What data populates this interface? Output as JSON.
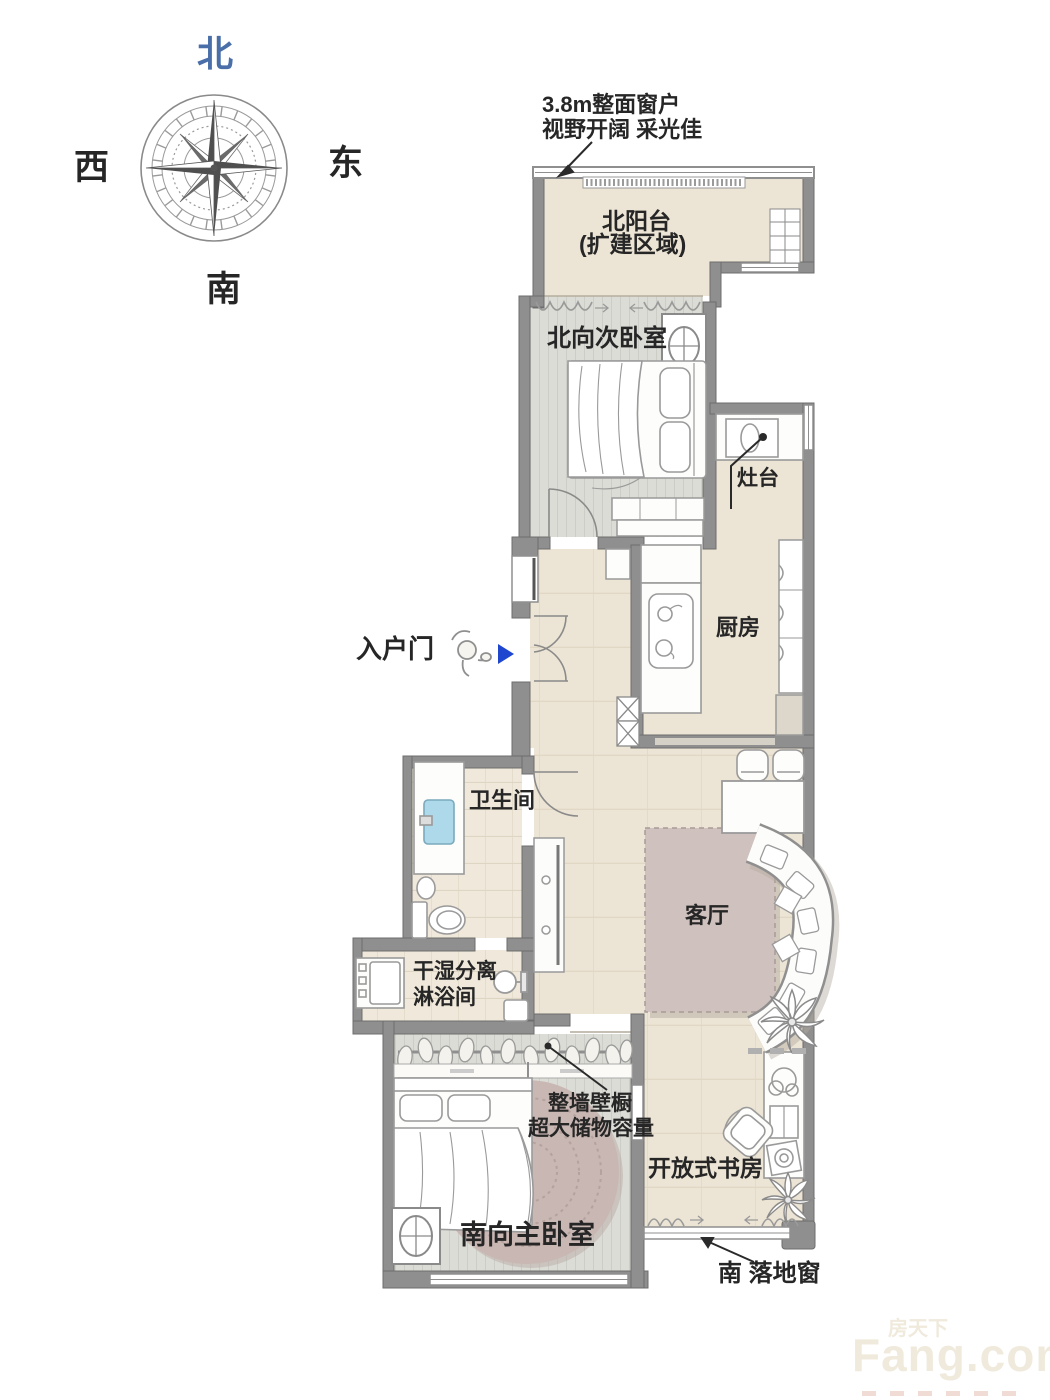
{
  "compass": {
    "north": "北",
    "east": "东",
    "south": "南",
    "west": "西"
  },
  "callouts": {
    "top_window_line1": "3.8m整面窗户",
    "top_window_line2": "视野开阔 采光佳",
    "stove": "灶台",
    "entry_door": "入户门",
    "closet_line1": "整墙壁橱",
    "closet_line2": "超大储物容量",
    "south_window": "南 落地窗"
  },
  "rooms": {
    "north_balcony_line1": "北阳台",
    "north_balcony_line2": "(扩建区域)",
    "north_bedroom": "北向次卧室",
    "kitchen": "厨房",
    "bathroom": "卫生间",
    "shower_line1": "干湿分离",
    "shower_line2": "淋浴间",
    "living_room": "客厅",
    "master_bedroom": "南向主卧室",
    "study": "开放式书房"
  },
  "watermark": {
    "cn": "房天下",
    "brand": "Fang.com"
  },
  "colors": {
    "wall": "#8f8f8f",
    "floor_warm": "#ece4d4",
    "floor_tile": "#f0e9db",
    "floor_bedroom": "#dcdcd6",
    "rug_living": "#cfc1bd",
    "rug_round": "#c9b7b3",
    "north_label_blue": "#4a6fa8",
    "entry_arrow_blue": "#1f46cf",
    "sink_blue": "#aed9ea"
  }
}
